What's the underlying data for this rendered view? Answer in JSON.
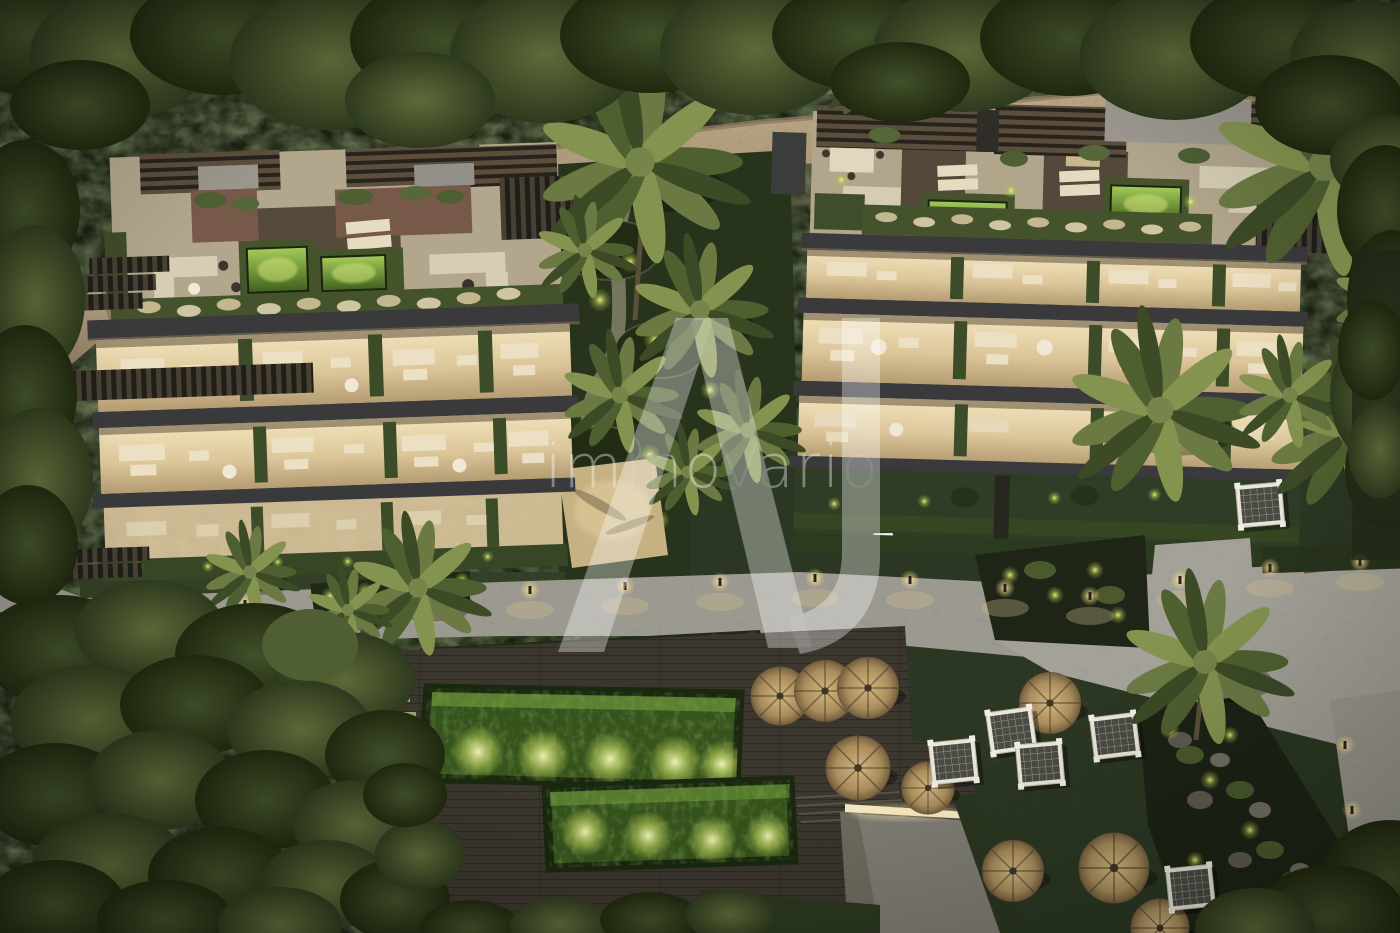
{
  "watermark": {
    "text": "immoVario",
    "monogram": "A",
    "color": "#ffffff",
    "opacity": 0.38
  },
  "scene": {
    "description": "Aerial dusk rendering of a luxury apartment complex: two terraced residential buildings with warmly illuminated floors, rooftop terraces with pergolas and glowing green plunge pools, palm gardens, lit walkways with bollard lights, a large green-illuminated natural swimming pool on a timber deck, straw parasols, white canopy daybeds, a stone retaining wall and dense surrounding forest.",
    "time_of_day": "dusk"
  },
  "palette": {
    "forest_dark": "#1b2212",
    "forest_mid": "#2e3a22",
    "canopy_olive": "#55663a",
    "stone_wall": "#a8947455",
    "slab_charcoal": "#3a3a3d",
    "terrace_warm": "#e8d8ac",
    "roof_concrete": "#b2a68c",
    "hedge_green": "#45532d",
    "pool_glow": "#cade62",
    "pool_deep": "#2c4a18",
    "path_gray": "#9b9990",
    "lamp_warm": "#ffedb3",
    "parasol_straw": "#cdb27c",
    "cabana_white": "#e9e6da",
    "deck_wood": "#3b362e"
  }
}
